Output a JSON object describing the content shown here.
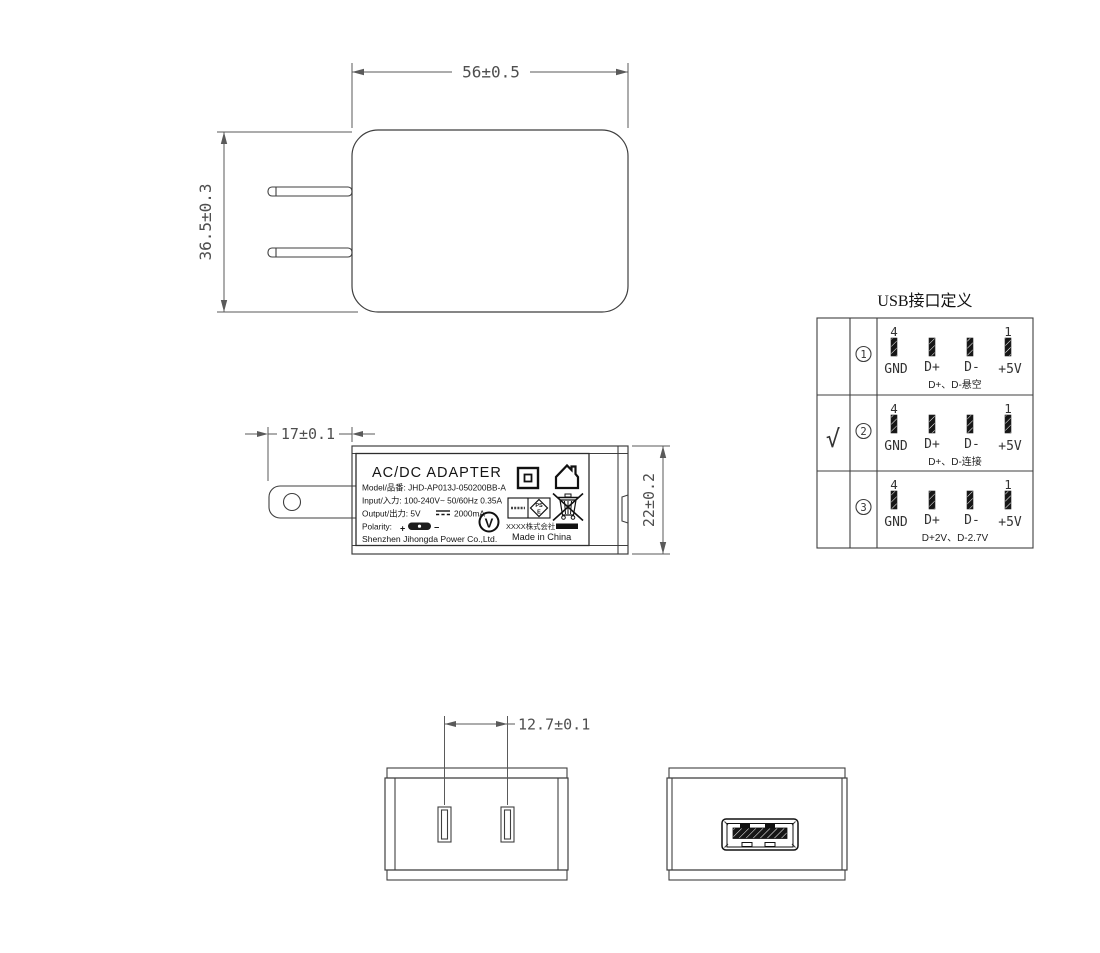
{
  "dimensions": {
    "body_width": "56±0.5",
    "body_height": "36.5±0.3",
    "prong_length": "17±0.1",
    "body_depth": "22±0.2",
    "pin_pitch": "12.7±0.1"
  },
  "label": {
    "title": "AC/DC  ADAPTER",
    "model_line": "Model/品番: JHD-AP013J-050200BB-A",
    "input_line": "Input/入力: 100-240V~  50/60Hz  0.35A",
    "output_prefix": "Output/出力: 5V",
    "output_suffix": "2000mA",
    "polarity_label": "Polarity:",
    "polarity_plus": "+",
    "polarity_minus": "−",
    "company": "Shenzhen Jihongda Power Co.,Ltd.",
    "cert_v": "V",
    "pse_line1": "PS",
    "pse_line2": "E",
    "cert_company": "XXXX株式会社",
    "made_in": "Made in China"
  },
  "usb_table": {
    "title": "USB接口定义",
    "pin_left_number": "4",
    "pin_right_number": "1",
    "pin_labels": [
      "GND",
      "D+",
      "D-",
      "+5V"
    ],
    "rows": [
      {
        "check": "",
        "num": "1",
        "caption": "D+、D-悬空"
      },
      {
        "check": "√",
        "num": "2",
        "caption": "D+、D-连接"
      },
      {
        "check": "",
        "num": "3",
        "caption": "D+2V、D-2.7V"
      }
    ]
  }
}
